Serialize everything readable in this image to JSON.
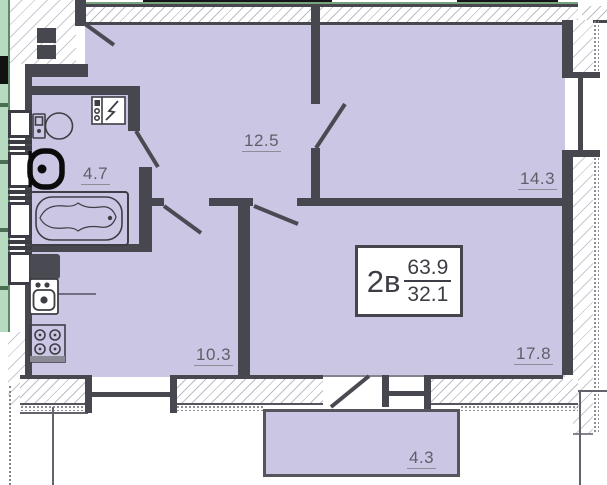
{
  "plan": {
    "title": "apartment-floor-plan",
    "unit": {
      "type_label": "2в",
      "area_total": "63.9",
      "area_living": "32.1"
    },
    "rooms": [
      {
        "id": "hall",
        "area": "12.5"
      },
      {
        "id": "bedroom",
        "area": "14.3"
      },
      {
        "id": "bathroom",
        "area": "4.7"
      },
      {
        "id": "kitchen",
        "area": "10.3"
      },
      {
        "id": "living-room",
        "area": "17.8"
      },
      {
        "id": "balcony",
        "area": "4.3"
      }
    ],
    "fixtures": [
      "toilet",
      "washbasin",
      "washing-machine",
      "bathtub",
      "fridge",
      "kitchen-sink",
      "stove"
    ],
    "colors": {
      "room_fill": "#cbc6e3",
      "wall": "#47474f",
      "label_text": "#5f5f6a",
      "adjacent_green": "#b7dbc0",
      "hatch_line": "#bcbcc6"
    }
  }
}
